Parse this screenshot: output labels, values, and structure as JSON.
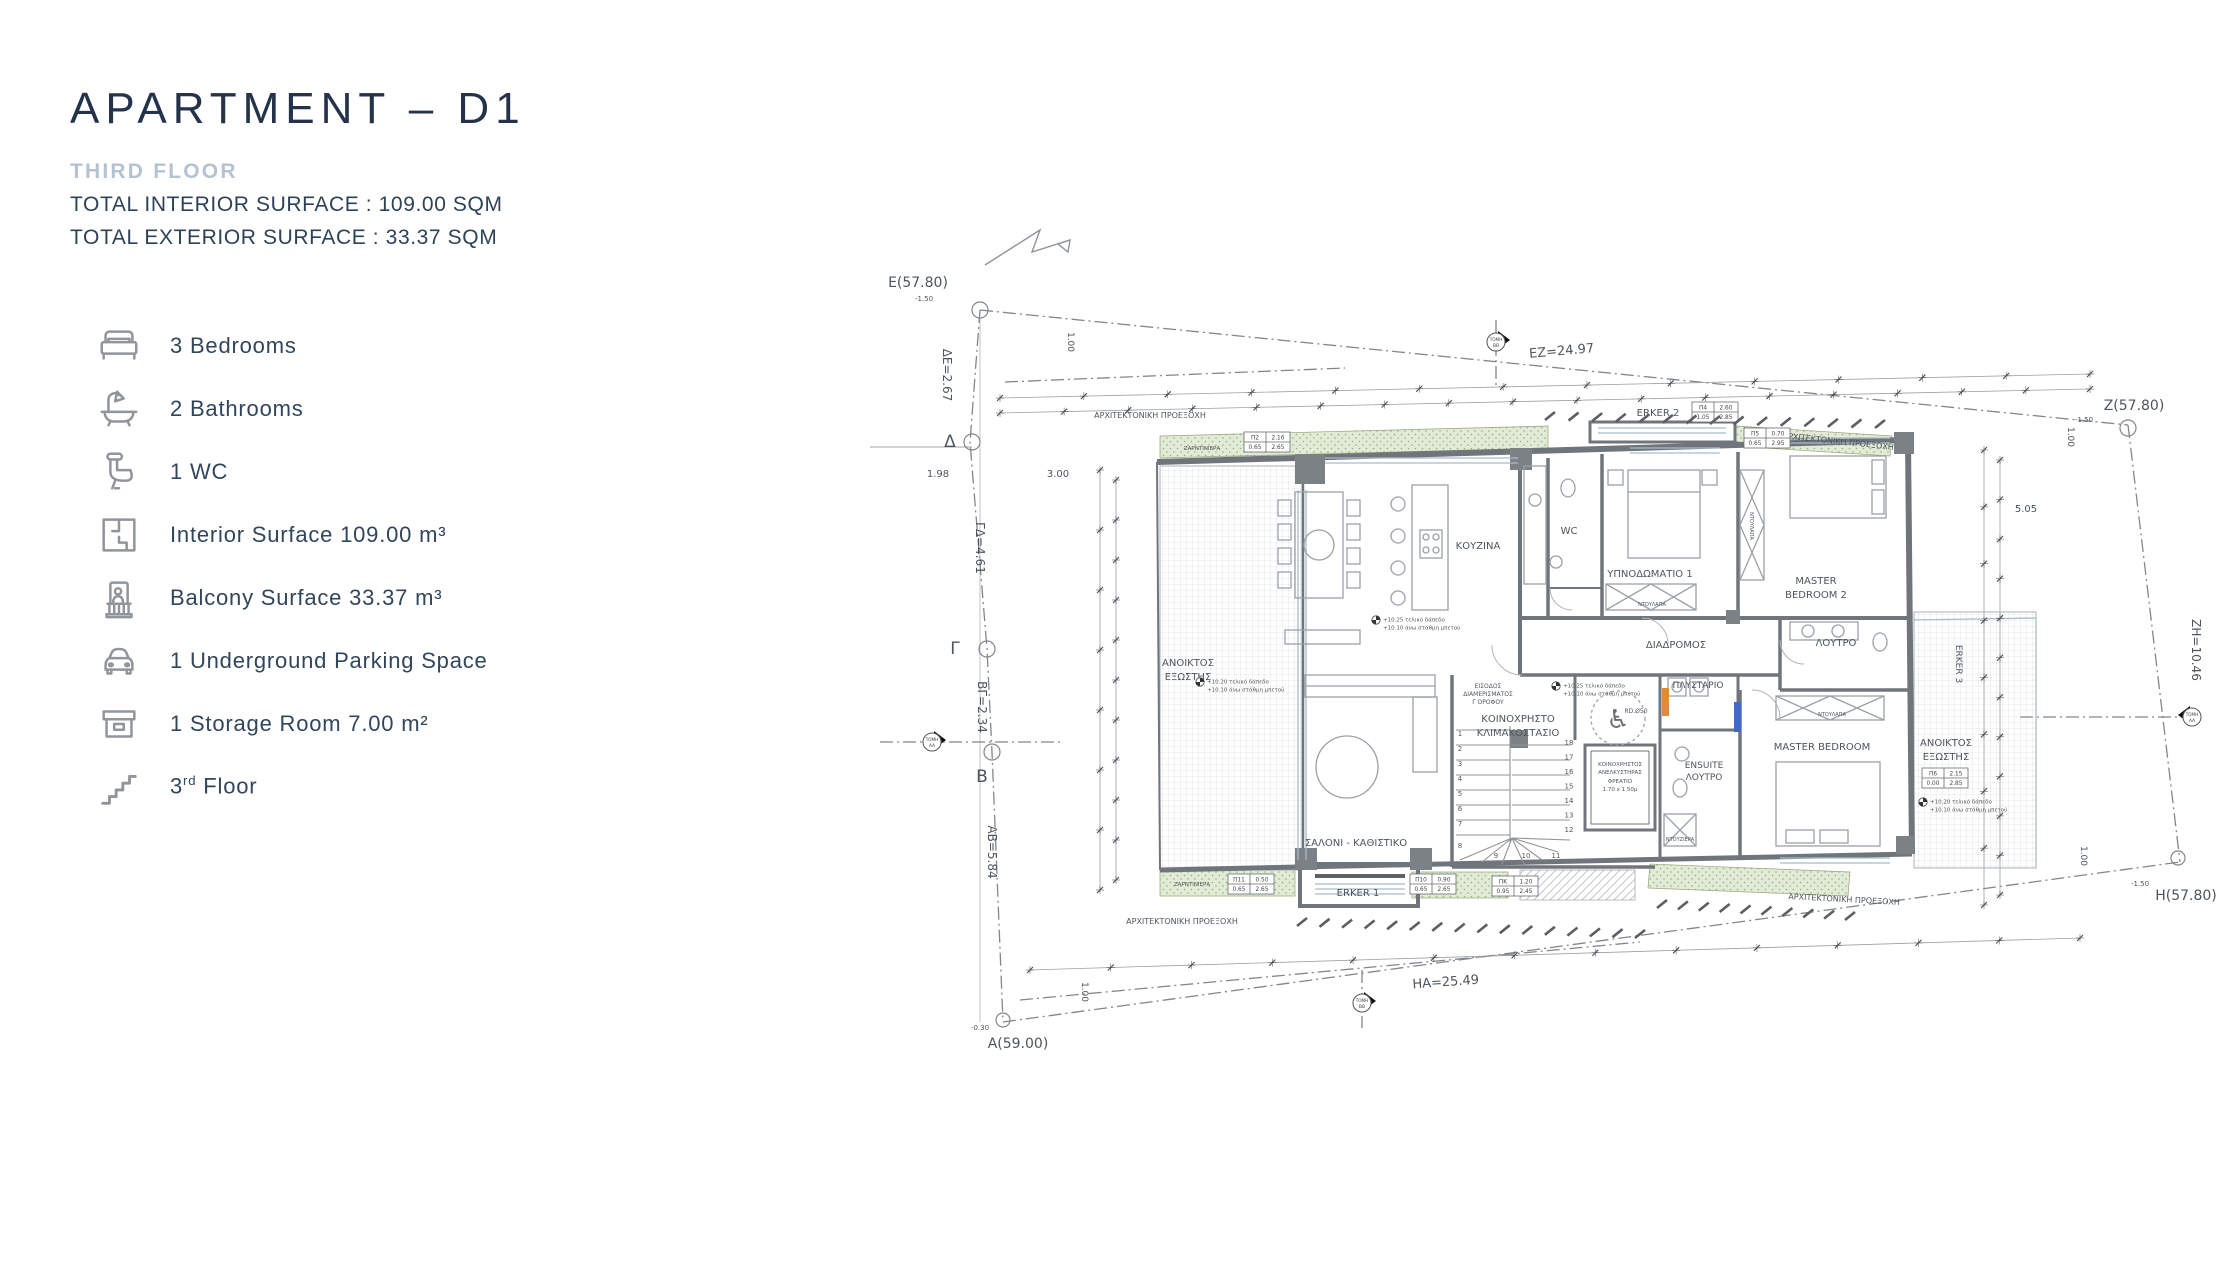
{
  "header": {
    "title": "APARTMENT – D1",
    "subtitle": "THIRD FLOOR",
    "interior_line": "TOTAL INTERIOR SURFACE :  109.00 SQM",
    "exterior_line": "TOTAL EXTERIOR SURFACE : 33.37 SQM"
  },
  "features": [
    {
      "icon": "bed-icon",
      "label": "3 Bedrooms"
    },
    {
      "icon": "bathtub-icon",
      "label": "2 Bathrooms"
    },
    {
      "icon": "toilet-icon",
      "label": "1 WC"
    },
    {
      "icon": "floor-plan-icon",
      "label": "Interior Surface 109.00 m³"
    },
    {
      "icon": "balcony-icon",
      "label": "Balcony Surface 33.37 m³"
    },
    {
      "icon": "car-icon",
      "label": "1 Underground Parking Space"
    },
    {
      "icon": "storage-box-icon",
      "label": "1 Storage Room 7.00 m²"
    },
    {
      "icon": "stairs-icon",
      "prefix": "3",
      "sup": "rd",
      "suffix": " Floor"
    }
  ],
  "colors": {
    "title": "#24334a",
    "subtitle": "#b5c2d2",
    "body_text": "#2d4257",
    "icon_gray": "#90959c",
    "plan_green": "#e2ebd5",
    "wall_gray": "#70757b",
    "accent_orange": "#e0893f",
    "accent_blue": "#4169c8"
  },
  "plan": {
    "labels": [
      {
        "t": "E(57.80)",
        "x": 278,
        "y": 117,
        "s": 14
      },
      {
        "t": "-1.50",
        "x": 284,
        "y": 131,
        "s": 7
      },
      {
        "t": "ΔΕ=2.67",
        "x": 303,
        "y": 205,
        "s": 12,
        "r": 90
      },
      {
        "t": "Δ",
        "x": 310,
        "y": 277,
        "s": 17
      },
      {
        "t": "1.98",
        "x": 298,
        "y": 307,
        "s": 10
      },
      {
        "t": "3.00",
        "x": 418,
        "y": 307,
        "s": 10
      },
      {
        "t": "ΓΔ=4.61",
        "x": 336,
        "y": 378,
        "s": 12,
        "r": 90
      },
      {
        "t": "Γ",
        "x": 315,
        "y": 484,
        "s": 17
      },
      {
        "t": "ΒΓ=2.34",
        "x": 338,
        "y": 537,
        "s": 12,
        "r": 90
      },
      {
        "t": "Β",
        "x": 342,
        "y": 612,
        "s": 17
      },
      {
        "t": "ΑΒ=5.84",
        "x": 348,
        "y": 682,
        "s": 12,
        "r": 90
      },
      {
        "t": "A(59.00)",
        "x": 378,
        "y": 878,
        "s": 14
      },
      {
        "t": "-0.30",
        "x": 340,
        "y": 860,
        "s": 7
      },
      {
        "t": "EZ=24.97",
        "x": 922,
        "y": 185,
        "s": 13,
        "r": -5
      },
      {
        "t": "Z(57.80)",
        "x": 1494,
        "y": 240,
        "s": 14
      },
      {
        "t": "-1.50",
        "x": 1444,
        "y": 252,
        "s": 7
      },
      {
        "t": "5.05",
        "x": 1386,
        "y": 342,
        "s": 10
      },
      {
        "t": "ZH=10.46",
        "x": 1552,
        "y": 480,
        "s": 12,
        "r": 90
      },
      {
        "t": "H(57.80)",
        "x": 1546,
        "y": 730,
        "s": 14
      },
      {
        "t": "-1.50",
        "x": 1500,
        "y": 716,
        "s": 7
      },
      {
        "t": "HA=25.49",
        "x": 806,
        "y": 816,
        "s": 13,
        "r": -4
      },
      {
        "t": "1.00",
        "x": 428,
        "y": 172,
        "s": 9,
        "r": 90
      },
      {
        "t": "1.00",
        "x": 442,
        "y": 822,
        "s": 9,
        "r": 90
      },
      {
        "t": "1.00",
        "x": 1428,
        "y": 267,
        "s": 9,
        "r": 90
      },
      {
        "t": "1.00",
        "x": 1441,
        "y": 686,
        "s": 9,
        "r": 90
      },
      {
        "t": "ΚΟΥΖΙΝΑ",
        "x": 838,
        "y": 379,
        "s": 10
      },
      {
        "t": "WC",
        "x": 929,
        "y": 364,
        "s": 10
      },
      {
        "t": "ΥΠΝΟΔΩΜΑΤΙΟ 1",
        "x": 1010,
        "y": 407,
        "s": 10
      },
      {
        "t": "MASTER",
        "x": 1176,
        "y": 414,
        "s": 10
      },
      {
        "t": "BEDROOM 2",
        "x": 1176,
        "y": 428,
        "s": 10
      },
      {
        "t": "ΔΙΑΔΡΟΜΟΣ",
        "x": 1036,
        "y": 478,
        "s": 10
      },
      {
        "t": "ΛΟΥΤΡΟ",
        "x": 1196,
        "y": 476,
        "s": 10
      },
      {
        "t": "ΠΛΥΣΤΑΡΙΟ",
        "x": 1058,
        "y": 518,
        "s": 9
      },
      {
        "t": "ENSUITE",
        "x": 1064,
        "y": 598,
        "s": 9
      },
      {
        "t": "ΛΟΥΤΡΟ",
        "x": 1064,
        "y": 610,
        "s": 9
      },
      {
        "t": "MASTER BEDROOM",
        "x": 1182,
        "y": 580,
        "s": 10
      },
      {
        "t": "ΑΝΟΙΚΤΟΣ",
        "x": 548,
        "y": 496,
        "s": 10
      },
      {
        "t": "ΕΞΩΣΤΗΣ",
        "x": 548,
        "y": 510,
        "s": 10
      },
      {
        "t": "ΑΝΟΙΚΤΟΣ",
        "x": 1306,
        "y": 576,
        "s": 10
      },
      {
        "t": "ΕΞΩΣΤΗΣ",
        "x": 1306,
        "y": 590,
        "s": 10
      },
      {
        "t": "ΣΑΛΟΝΙ - ΚΑΘΙΣΤΙΚΟ",
        "x": 716,
        "y": 676,
        "s": 10
      },
      {
        "t": "ΚΟΙΝΟΧΡΗΣΤΟ",
        "x": 878,
        "y": 552,
        "s": 10
      },
      {
        "t": "ΚΛΙΜΑΚΟΣΤΑΣΙΟ",
        "x": 878,
        "y": 566,
        "s": 10
      },
      {
        "t": "ΕΙΣΟΔΟΣ",
        "x": 848,
        "y": 518,
        "s": 6
      },
      {
        "t": "ΔΙΑΜΕΡΙΣΜΑΤΟΣ",
        "x": 848,
        "y": 526,
        "s": 6
      },
      {
        "t": "Γ ΟΡΟΦΟΥ",
        "x": 848,
        "y": 534,
        "s": 6
      },
      {
        "t": "ΚΟΙΝΟΧΡΗΣΤΟΣ",
        "x": 980,
        "y": 596,
        "s": 5.5
      },
      {
        "t": "ΑΝΕΛΚΥΣΤΗΡΑΣ",
        "x": 980,
        "y": 604,
        "s": 5.5
      },
      {
        "t": "ΦΡΕΑΤΙΟ",
        "x": 980,
        "y": 613,
        "s": 5.5
      },
      {
        "t": "1.70 x 1.50μ",
        "x": 980,
        "y": 621,
        "s": 5.5
      },
      {
        "t": "ERKER 1",
        "x": 718,
        "y": 726,
        "s": 10
      },
      {
        "t": "ERKER 2",
        "x": 1018,
        "y": 246,
        "s": 10
      },
      {
        "t": "ERKER 3",
        "x": 1316,
        "y": 494,
        "s": 9,
        "r": 90
      },
      {
        "t": "ΑΡΧΙΤΕΚΤΟΝΙΚΗ ΠΡΟΕΞΟΧΗ",
        "x": 510,
        "y": 248,
        "s": 8
      },
      {
        "t": "ΑΡΧΙΤΕΚΤΟΝΙΚΗ ΠΡΟΕΞΟΧΗ",
        "x": 1198,
        "y": 274,
        "s": 8,
        "r": 6
      },
      {
        "t": "ΑΡΧΙΤΕΚΤΟΝΙΚΗ ΠΡΟΕΞΟΧΗ",
        "x": 542,
        "y": 754,
        "s": 8
      },
      {
        "t": "ΑΡΧΙΤΕΚΤΟΝΙΚΗ ΠΡΟΕΞΟΧΗ",
        "x": 1204,
        "y": 732,
        "s": 8,
        "r": 3
      },
      {
        "t": "ΖΑΡΝΤΙΝΙΕΡΑ",
        "x": 562,
        "y": 280,
        "s": 5.5
      },
      {
        "t": "ΖΑΡΝΤΙΝΙΕΡΑ",
        "x": 1150,
        "y": 272,
        "s": 5.5
      },
      {
        "t": "ΖΑΡΝΤΙΝΙΕΡΑ",
        "x": 552,
        "y": 716,
        "s": 5.5
      },
      {
        "t": "ΝΤΟΥΛΑΠΑ",
        "x": 1012,
        "y": 436,
        "s": 5
      },
      {
        "t": "ΝΤΟΥΛΑΠΑ",
        "x": 1110,
        "y": 356,
        "s": 5,
        "r": 90
      },
      {
        "t": "ΝΤΟΥΛΑΠΑ",
        "x": 1192,
        "y": 546,
        "s": 5
      },
      {
        "t": "ΝΤΟΥΖΙΕΡΑ",
        "x": 1040,
        "y": 671,
        "s": 5
      },
      {
        "t": "RD.Ø50",
        "x": 996,
        "y": 543,
        "s": 6
      },
      {
        "t": "♿",
        "x": 978,
        "y": 558,
        "s": 26,
        "c": "#6a7077"
      }
    ],
    "chips": [
      {
        "x": 1052,
        "y": 232,
        "c": [
          [
            "Π4",
            "2.60"
          ],
          [
            "1.05",
            "2.85"
          ]
        ]
      },
      {
        "x": 604,
        "y": 262,
        "c": [
          [
            "Π2",
            "2.16"
          ],
          [
            "0.65",
            "2.65"
          ]
        ]
      },
      {
        "x": 1104,
        "y": 258,
        "c": [
          [
            "Π5",
            "0.70"
          ],
          [
            "0.65",
            "2.95"
          ]
        ]
      },
      {
        "x": 588,
        "y": 704,
        "c": [
          [
            "Π11",
            "0.50"
          ],
          [
            "0.65",
            "2.65"
          ]
        ]
      },
      {
        "x": 770,
        "y": 704,
        "c": [
          [
            "Π10",
            "0.90"
          ],
          [
            "0.65",
            "2.65"
          ]
        ]
      },
      {
        "x": 852,
        "y": 706,
        "c": [
          [
            "ΠΚ",
            "1.20"
          ],
          [
            "0.95",
            "2.45"
          ]
        ]
      },
      {
        "x": 1282,
        "y": 598,
        "c": [
          [
            "Π6",
            "2.15"
          ],
          [
            "0.00",
            "2.85"
          ]
        ]
      }
    ],
    "levels": [
      {
        "x": 736,
        "y": 450,
        "l1": "+10.25 τελικό δάπεδο",
        "l2": "+10.10 άνω στάθμη μπετού"
      },
      {
        "x": 916,
        "y": 516,
        "l1": "+10.25 τελικό δάπεδο",
        "l2": "+10.10 άνω στάθμη μπετού"
      },
      {
        "x": 560,
        "y": 512,
        "l1": "+10.20 τελικό δάπεδο",
        "l2": "+10.10 άνω στάθμη μπετού"
      },
      {
        "x": 1283,
        "y": 632,
        "l1": "+10.20 τελικό δάπεδο",
        "l2": "+10.10 άνω στάθμη μπετού"
      }
    ],
    "section_markers": [
      {
        "x": 292,
        "y": 572,
        "l1": "ΤΟΜΗ",
        "l2": "ΑΑ",
        "dir": "right"
      },
      {
        "x": 1552,
        "y": 547,
        "l1": "ΤΟΜΗ",
        "l2": "ΑΑ",
        "dir": "left"
      },
      {
        "x": 856,
        "y": 172,
        "l1": "ΤΟΜΗ",
        "l2": "ΒΒ",
        "dir": "right"
      },
      {
        "x": 722,
        "y": 833,
        "l1": "ΤΟΜΗ",
        "l2": "ΒΒ",
        "dir": "right"
      }
    ],
    "stair_numbers": {
      "left": [
        "1",
        "2",
        "3",
        "4",
        "5",
        "6",
        "7",
        "8"
      ],
      "bottom": [
        "9",
        "10",
        "11"
      ],
      "right": [
        "12",
        "13",
        "14",
        "15",
        "16",
        "17",
        "18"
      ]
    }
  }
}
